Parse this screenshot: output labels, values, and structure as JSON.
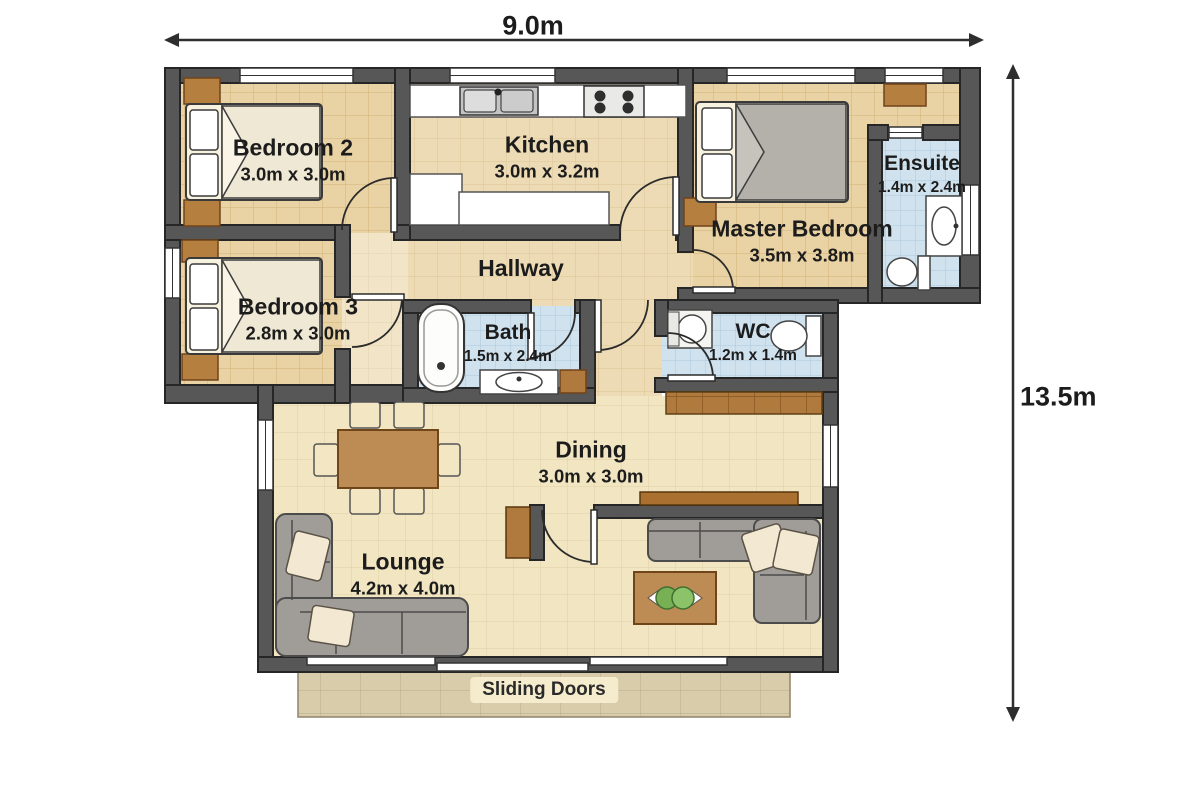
{
  "dimensions": {
    "width_label": "9.0m",
    "height_label": "13.5m"
  },
  "rooms": [
    {
      "id": "bedroom2",
      "name": "Bedroom 2",
      "size": "3.0m x 3.0m"
    },
    {
      "id": "kitchen",
      "name": "Kitchen",
      "size": "3.0m x 3.2m"
    },
    {
      "id": "master_bedroom",
      "name": "Master Bedroom",
      "size": "3.5m x 3.8m"
    },
    {
      "id": "ensuite",
      "name": "Ensuite",
      "size": "1.4m x 2.4m"
    },
    {
      "id": "bedroom3",
      "name": "Bedroom 3",
      "size": "2.8m x 3.0m"
    },
    {
      "id": "hallway",
      "name": "Hallway",
      "size": ""
    },
    {
      "id": "bath",
      "name": "Bath",
      "size": "1.5m x 2.4m"
    },
    {
      "id": "wc",
      "name": "WC",
      "size": "1.2m x 1.4m"
    },
    {
      "id": "dining",
      "name": "Dining",
      "size": "3.0m x 3.0m"
    },
    {
      "id": "lounge",
      "name": "Lounge",
      "size": "4.2m x 4.0m"
    }
  ],
  "patio": {
    "label": "Sliding Doors"
  },
  "colors": {
    "wall": "#575757",
    "floor_bedroom": "#e9d2a3",
    "floor_hall": "#eddbb5",
    "floor_living": "#f2e6c2",
    "floor_wet": "#d0e2ed",
    "patio": "#d9ccab",
    "wood": "#bd8c55",
    "cabinet_brown": "#b0793e",
    "sofa_gray": "#a09d98"
  }
}
